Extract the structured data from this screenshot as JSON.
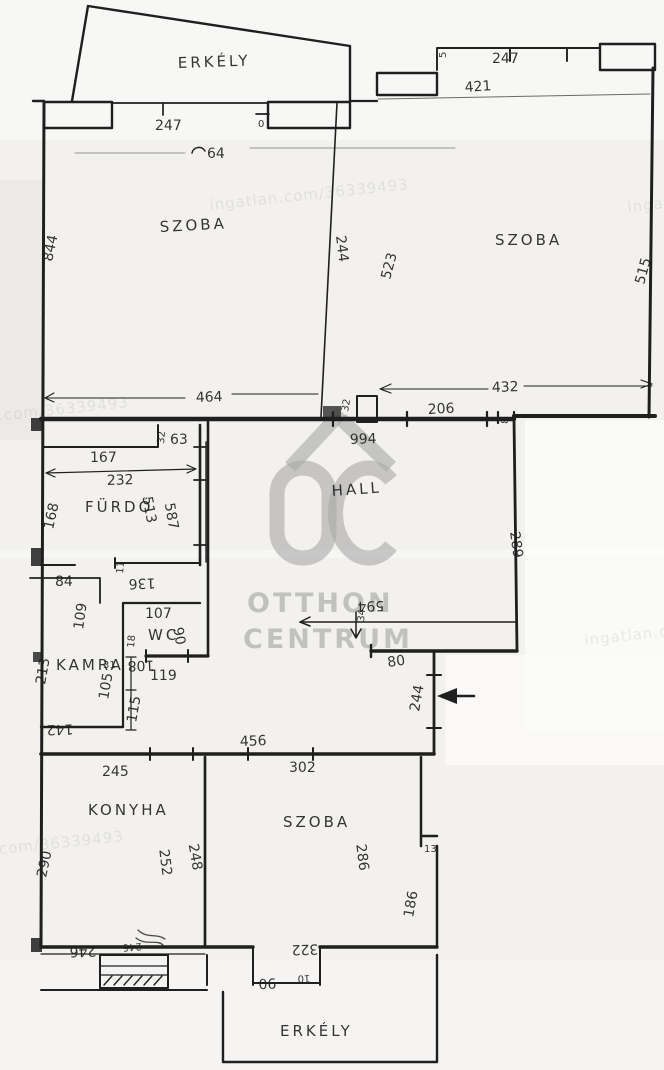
{
  "document_type": "hand-drawn floor plan photo",
  "colors": {
    "ink": "#1f1f1f",
    "paper": "#f2f1ee",
    "watermark_gray": "#a8a8a8"
  },
  "rooms": {
    "erkely_top": "ERKÉLY",
    "szoba_top_left": "SZOBA",
    "szoba_top_right": "SZOBA",
    "hall": "HALL",
    "furdo": "FÜRDŐ",
    "wc": "WC",
    "kamra": "KAMRA",
    "konyha": "KONYHA",
    "szoba_bottom": "SZOBA",
    "erkely_bottom": "ERKÉLY"
  },
  "dims": {
    "d247_left": "247",
    "d0": "0",
    "d64": "64",
    "d844": "844",
    "d244_divider": "244",
    "d464": "464",
    "d5": "5",
    "d247_right": "247",
    "d421": "421",
    "d523": "523",
    "d515": "515",
    "d432": "432",
    "d206": "206",
    "d8": "8",
    "d994": "994",
    "d32_chimney": "32",
    "d289": "289",
    "d594": "594",
    "d34": "34",
    "d80": "80",
    "d244_entry": "244",
    "d32_niche": "32",
    "d63": "63",
    "d167": "167",
    "d232": "232",
    "d168": "168",
    "d513": "513",
    "d587": "587",
    "d136": "136",
    "d11": "11",
    "d84": "84",
    "d109": "109",
    "d107": "107",
    "d90_wc": "90",
    "d18": "18",
    "d108": "108",
    "d119": "119",
    "d213": "213",
    "d31": "31",
    "d105": "105",
    "d115": "115",
    "d142": "142",
    "d456": "456",
    "d245": "245",
    "d302": "302",
    "d290": "290",
    "d252": "252",
    "d248": "248",
    "d286": "286",
    "d13": "13",
    "d186": "186",
    "d322": "322",
    "d90_door": "90",
    "d10": "10",
    "d246": "246",
    "d246b": "246"
  },
  "watermark": {
    "logo": "OC house logo",
    "brand_line1": "OTTHON",
    "brand_line2": "CENTRUM",
    "site": "ingatlan.com/36339493"
  }
}
